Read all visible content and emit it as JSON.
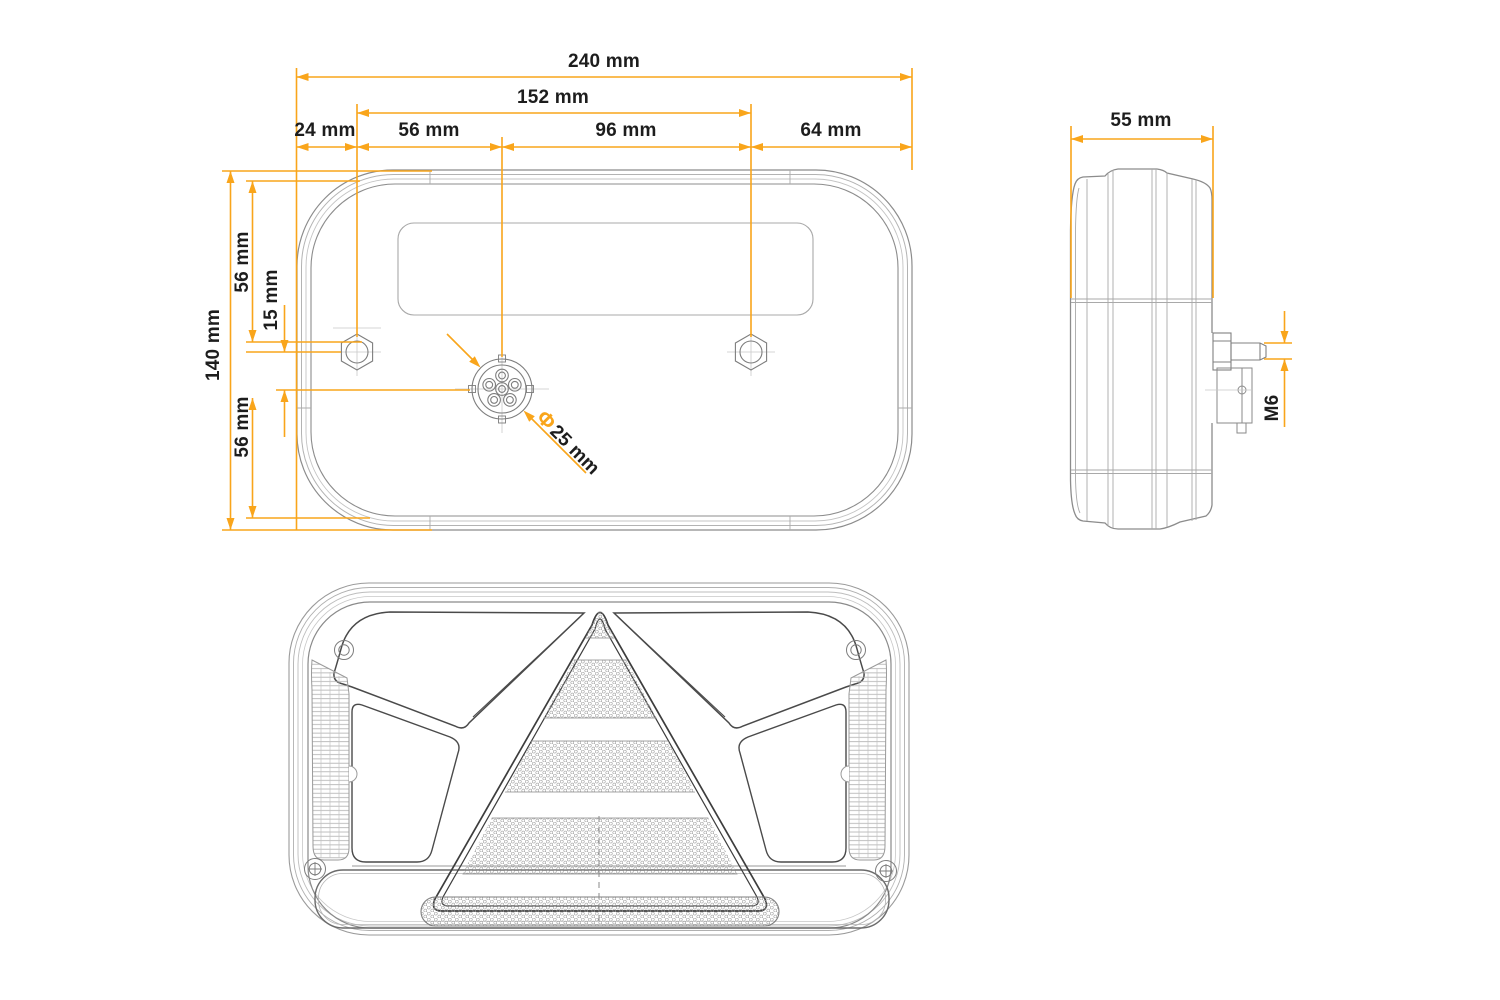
{
  "colors": {
    "accent": "#F9A51B",
    "ink": "#1D1D1D"
  },
  "drawing": {
    "back_view": {
      "dim_total_width": "240 mm",
      "dim_hole_span": "152 mm",
      "dim_left_edge_to_hole": "24 mm",
      "dim_hole_to_connector": "56 mm",
      "dim_connector_to_hole": "96 mm",
      "dim_hole_to_right_edge": "64 mm",
      "dim_total_height": "140 mm",
      "dim_top_to_hole": "56 mm",
      "dim_hole_to_connector_vertical": "15 mm",
      "dim_connector_to_bottom": "56 mm",
      "dim_connector_diameter_symbol": "Φ",
      "dim_connector_diameter_value": "25 mm"
    },
    "side_view": {
      "dim_depth": "55 mm",
      "dim_stud_thread": "M6"
    }
  }
}
